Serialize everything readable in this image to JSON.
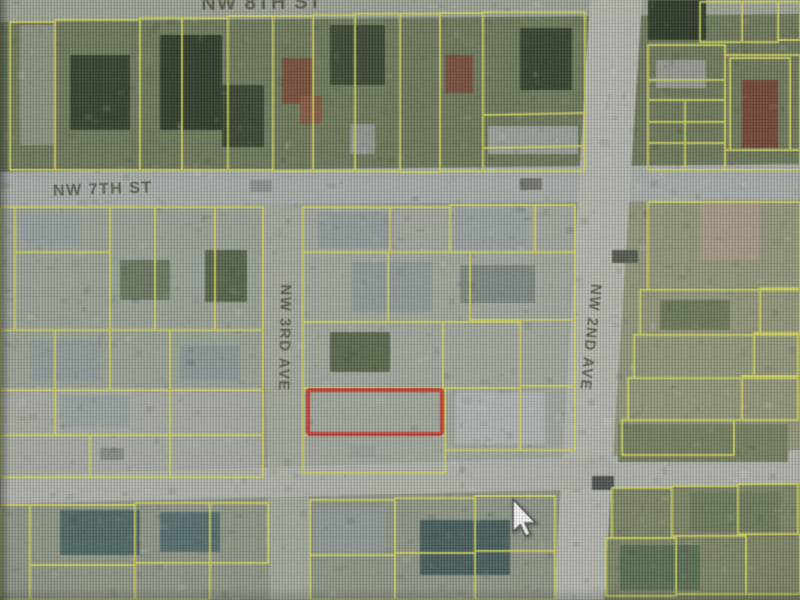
{
  "map": {
    "title": "aerial parcel map",
    "colors": {
      "parcel_line": "#d4d64c",
      "highlight": "#d23c30",
      "label_text": "#4e4e38",
      "street_fill": "#a9afa6"
    },
    "street_labels": [
      {
        "id": "street-label-top",
        "text": "NW 8TH ST",
        "x": 262,
        "y": 9,
        "rotate": -1,
        "size": 20
      },
      {
        "id": "street-label-nw-7th-st",
        "text": "NW 7TH ST",
        "x": 103,
        "y": 194,
        "rotate": -2,
        "size": 16
      },
      {
        "id": "street-label-nw-3rd-ave",
        "text": "NW 3RD AVE",
        "x": 280,
        "y": 338,
        "rotate": 91,
        "size": 15
      },
      {
        "id": "street-label-nw-2nd-ave",
        "text": "NW 2ND AVE",
        "x": 586,
        "y": 337,
        "rotate": 96,
        "size": 15
      }
    ],
    "streets": [
      {
        "id": "street-top",
        "fill": "#9ba394",
        "pts": [
          [
            0,
            0
          ],
          [
            800,
            0
          ],
          [
            800,
            14
          ],
          [
            0,
            22
          ]
        ]
      },
      {
        "id": "street-nw-7th-st",
        "fill": "#a7aea8",
        "pts": [
          [
            0,
            172
          ],
          [
            800,
            164
          ],
          [
            800,
            200
          ],
          [
            0,
            207
          ]
        ]
      },
      {
        "id": "street-nw-3rd-ave",
        "fill": "#a3a89c",
        "pts": [
          [
            262,
            205
          ],
          [
            302,
            205
          ],
          [
            312,
            600
          ],
          [
            270,
            600
          ]
        ]
      },
      {
        "id": "street-nw-2nd-ave",
        "fill": "#b2b7ad",
        "pts": [
          [
            590,
            0
          ],
          [
            642,
            0
          ],
          [
            604,
            600
          ],
          [
            554,
            600
          ]
        ]
      },
      {
        "id": "street-cross",
        "fill": "#aeb3a9",
        "pts": [
          [
            0,
            476
          ],
          [
            800,
            450
          ],
          [
            800,
            484
          ],
          [
            0,
            504
          ]
        ]
      }
    ],
    "base_regions": [
      {
        "x": 0,
        "y": 0,
        "w": 800,
        "h": 172,
        "f": "#6e7a58"
      },
      {
        "x": 0,
        "y": 205,
        "w": 263,
        "h": 275,
        "f": "#9aa295"
      },
      {
        "x": 303,
        "y": 205,
        "w": 272,
        "h": 275,
        "f": "#a0a79c"
      },
      {
        "x": 610,
        "y": 172,
        "w": 190,
        "h": 312,
        "f": "#939779"
      },
      {
        "x": 0,
        "y": 480,
        "w": 800,
        "h": 120,
        "f": "#8e9786"
      },
      {
        "x": 560,
        "y": 484,
        "w": 240,
        "h": 116,
        "f": "#7c8663"
      },
      {
        "x": 0,
        "y": 388,
        "w": 260,
        "h": 88,
        "f": "#a6aba1"
      }
    ],
    "features": [
      {
        "x": 70,
        "y": 55,
        "w": 60,
        "h": 75,
        "f": "#36432c"
      },
      {
        "x": 160,
        "y": 35,
        "w": 62,
        "h": 95,
        "f": "#313f2b"
      },
      {
        "x": 222,
        "y": 85,
        "w": 42,
        "h": 62,
        "f": "#3a4830"
      },
      {
        "x": 330,
        "y": 25,
        "w": 55,
        "h": 60,
        "f": "#3c4a31"
      },
      {
        "x": 520,
        "y": 28,
        "w": 52,
        "h": 62,
        "f": "#37452d"
      },
      {
        "x": 20,
        "y": 25,
        "w": 35,
        "h": 120,
        "f": "#8b937f"
      },
      {
        "x": 282,
        "y": 58,
        "w": 30,
        "h": 46,
        "f": "#7d5038"
      },
      {
        "x": 300,
        "y": 96,
        "w": 22,
        "h": 28,
        "f": "#8a5a40"
      },
      {
        "x": 445,
        "y": 55,
        "w": 28,
        "h": 38,
        "f": "#7d4f38"
      },
      {
        "x": 350,
        "y": 124,
        "w": 25,
        "h": 30,
        "f": "#8f968f"
      },
      {
        "x": 488,
        "y": 126,
        "w": 90,
        "h": 28,
        "f": "#9aa098"
      },
      {
        "x": 648,
        "y": 0,
        "w": 58,
        "h": 40,
        "f": "#2e3b28"
      },
      {
        "x": 742,
        "y": 80,
        "w": 36,
        "h": 68,
        "f": "#7a4634"
      },
      {
        "x": 656,
        "y": 60,
        "w": 50,
        "h": 28,
        "f": "#97998f"
      },
      {
        "x": 318,
        "y": 212,
        "w": 75,
        "h": 36,
        "f": "#939c9c"
      },
      {
        "x": 455,
        "y": 208,
        "w": 72,
        "h": 42,
        "f": "#99a1a1"
      },
      {
        "x": 352,
        "y": 262,
        "w": 80,
        "h": 50,
        "f": "#8f9a9a"
      },
      {
        "x": 460,
        "y": 265,
        "w": 75,
        "h": 38,
        "f": "#7f8b82"
      },
      {
        "x": 455,
        "y": 392,
        "w": 90,
        "h": 52,
        "f": "#aeb5b3"
      },
      {
        "x": 330,
        "y": 332,
        "w": 60,
        "h": 40,
        "f": "#5c6b4a"
      },
      {
        "x": 205,
        "y": 250,
        "w": 42,
        "h": 52,
        "f": "#596649"
      },
      {
        "x": 20,
        "y": 215,
        "w": 60,
        "h": 30,
        "f": "#96a0a0"
      },
      {
        "x": 120,
        "y": 260,
        "w": 50,
        "h": 40,
        "f": "#6b7a5e"
      },
      {
        "x": 30,
        "y": 340,
        "w": 70,
        "h": 40,
        "f": "#929c9a"
      },
      {
        "x": 180,
        "y": 345,
        "w": 60,
        "h": 35,
        "f": "#8e9898"
      },
      {
        "x": 60,
        "y": 395,
        "w": 70,
        "h": 32,
        "f": "#99a3a1"
      },
      {
        "x": 60,
        "y": 510,
        "w": 80,
        "h": 45,
        "f": "#4f6a68"
      },
      {
        "x": 160,
        "y": 512,
        "w": 60,
        "h": 40,
        "f": "#557070"
      },
      {
        "x": 315,
        "y": 508,
        "w": 70,
        "h": 45,
        "f": "#8f9a98"
      },
      {
        "x": 420,
        "y": 520,
        "w": 90,
        "h": 55,
        "f": "#47605f"
      },
      {
        "x": 620,
        "y": 545,
        "w": 80,
        "h": 45,
        "f": "#5a6f52"
      },
      {
        "x": 690,
        "y": 492,
        "w": 90,
        "h": 40,
        "f": "#6f7c58"
      },
      {
        "x": 700,
        "y": 200,
        "w": 60,
        "h": 60,
        "f": "#a89a85"
      },
      {
        "x": 660,
        "y": 300,
        "w": 70,
        "h": 30,
        "f": "#6d7a55"
      },
      {
        "x": 618,
        "y": 424,
        "w": 170,
        "h": 38,
        "f": "#74815c"
      },
      {
        "x": 250,
        "y": 180,
        "w": 22,
        "h": 12,
        "f": "#8d9390"
      },
      {
        "x": 520,
        "y": 178,
        "w": 22,
        "h": 12,
        "f": "#74786f"
      },
      {
        "x": 100,
        "y": 448,
        "w": 24,
        "h": 12,
        "f": "#888f88"
      },
      {
        "x": 350,
        "y": 445,
        "w": 26,
        "h": 13,
        "f": "#9aa09a"
      },
      {
        "x": 612,
        "y": 250,
        "w": 26,
        "h": 13,
        "f": "#565d52"
      },
      {
        "x": 592,
        "y": 476,
        "w": 22,
        "h": 14,
        "f": "#4c5450"
      }
    ],
    "parcels": [
      [
        10,
        22,
        45,
        148
      ],
      [
        55,
        20,
        85,
        150
      ],
      [
        140,
        18,
        42,
        152
      ],
      [
        182,
        18,
        46,
        152
      ],
      [
        228,
        16,
        45,
        154
      ],
      [
        273,
        16,
        40,
        155
      ],
      [
        313,
        15,
        42,
        156
      ],
      [
        355,
        14,
        45,
        157
      ],
      [
        400,
        14,
        40,
        158
      ],
      [
        440,
        13,
        43,
        158
      ],
      [
        483,
        12,
        102,
        159
      ],
      [
        648,
        45,
        77,
        125
      ],
      [
        725,
        55,
        75,
        95
      ],
      [
        730,
        58,
        60,
        92
      ],
      [
        700,
        2,
        42,
        40
      ],
      [
        742,
        2,
        36,
        40
      ],
      [
        778,
        2,
        22,
        38
      ],
      [
        725,
        150,
        75,
        20
      ],
      [
        0,
        207,
        15,
        123
      ],
      [
        15,
        207,
        95,
        45
      ],
      [
        15,
        252,
        95,
        78
      ],
      [
        110,
        207,
        45,
        123
      ],
      [
        155,
        207,
        60,
        123
      ],
      [
        215,
        207,
        48,
        123
      ],
      [
        0,
        330,
        55,
        60
      ],
      [
        55,
        330,
        55,
        60
      ],
      [
        110,
        330,
        60,
        60
      ],
      [
        170,
        330,
        93,
        60
      ],
      [
        0,
        390,
        55,
        45
      ],
      [
        55,
        390,
        115,
        45
      ],
      [
        170,
        390,
        93,
        45
      ],
      [
        0,
        435,
        90,
        42
      ],
      [
        90,
        435,
        80,
        42
      ],
      [
        170,
        435,
        93,
        42
      ],
      [
        303,
        207,
        87,
        45
      ],
      [
        390,
        207,
        60,
        45
      ],
      [
        450,
        205,
        85,
        47
      ],
      [
        535,
        205,
        40,
        47
      ],
      [
        303,
        252,
        85,
        70
      ],
      [
        388,
        252,
        82,
        70
      ],
      [
        470,
        252,
        105,
        68
      ],
      [
        303,
        322,
        140,
        66
      ],
      [
        443,
        322,
        77,
        66
      ],
      [
        520,
        320,
        55,
        66
      ],
      [
        303,
        388,
        142,
        47
      ],
      [
        445,
        388,
        75,
        62
      ],
      [
        520,
        386,
        55,
        64
      ],
      [
        303,
        435,
        142,
        38
      ],
      [
        648,
        202,
        152,
        88
      ],
      [
        640,
        290,
        120,
        45
      ],
      [
        760,
        288,
        40,
        47
      ],
      [
        634,
        335,
        120,
        43
      ],
      [
        754,
        333,
        44,
        45
      ],
      [
        628,
        378,
        114,
        42
      ],
      [
        742,
        376,
        56,
        44
      ],
      [
        622,
        420,
        112,
        35
      ],
      [
        612,
        488,
        60,
        50
      ],
      [
        672,
        486,
        66,
        50
      ],
      [
        738,
        484,
        60,
        50
      ],
      [
        606,
        538,
        70,
        58
      ],
      [
        676,
        536,
        70,
        58
      ],
      [
        746,
        534,
        54,
        60
      ],
      [
        310,
        500,
        85,
        55
      ],
      [
        395,
        498,
        80,
        55
      ],
      [
        475,
        496,
        80,
        55
      ],
      [
        310,
        555,
        85,
        45
      ],
      [
        395,
        553,
        80,
        47
      ],
      [
        475,
        551,
        80,
        49
      ],
      [
        0,
        505,
        30,
        95
      ],
      [
        30,
        505,
        105,
        60
      ],
      [
        135,
        503,
        75,
        60
      ],
      [
        210,
        503,
        58,
        60
      ],
      [
        30,
        565,
        105,
        35
      ],
      [
        135,
        563,
        75,
        37
      ]
    ],
    "extra_lines": [
      [
        483,
        115,
        585,
        113
      ],
      [
        483,
        148,
        585,
        146
      ],
      [
        648,
        80,
        725,
        80
      ],
      [
        648,
        100,
        725,
        100
      ],
      [
        648,
        122,
        725,
        122
      ],
      [
        648,
        143,
        725,
        143
      ],
      [
        685,
        100,
        685,
        170
      ]
    ],
    "highlight_parcel": {
      "x": 308,
      "y": 390,
      "w": 134,
      "h": 44,
      "stroke_width": 4
    },
    "cursor": {
      "x": 513,
      "y": 499,
      "scale": 1.6
    },
    "noise": {
      "seed": 7,
      "count": 950
    }
  }
}
